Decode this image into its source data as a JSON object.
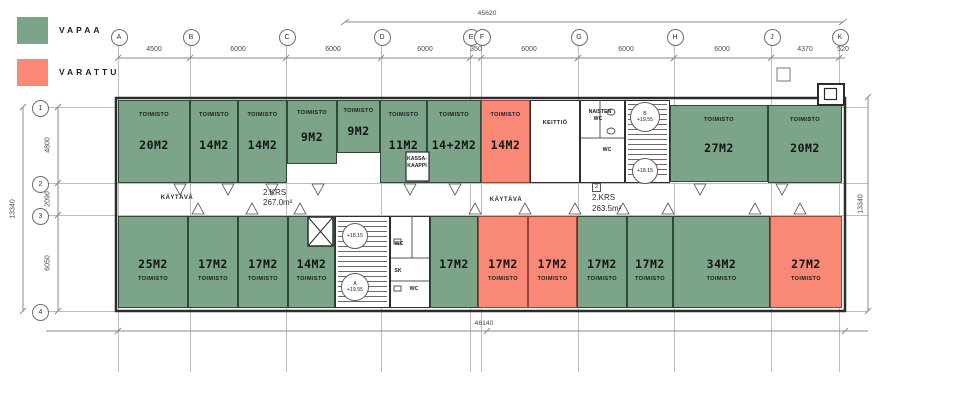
{
  "legend": {
    "items": [
      {
        "id": "vapaa",
        "label": "VAPAA",
        "color": "#7CA489"
      },
      {
        "id": "varattu",
        "label": "VARATTU",
        "color": "#F98877"
      }
    ]
  },
  "colors": {
    "vapaa": "#7CA489",
    "varattu": "#F98877",
    "wall": "#2F2F2F",
    "grid_line": "#BDBDBD",
    "dim_text": "#4C4C4C"
  },
  "dimensions": {
    "top_total": "45620",
    "bottom_total": "46140",
    "left_total": "13340",
    "right_total": "13340",
    "column_spans": [
      {
        "label": "4500",
        "x": 154
      },
      {
        "label": "6000",
        "x": 238
      },
      {
        "label": "6000",
        "x": 333
      },
      {
        "label": "6000",
        "x": 425
      },
      {
        "label": "350",
        "x": 476
      },
      {
        "label": "6000",
        "x": 529
      },
      {
        "label": "6000",
        "x": 626
      },
      {
        "label": "6000",
        "x": 722
      },
      {
        "label": "4370",
        "x": 805
      },
      {
        "label": "520",
        "x": 843
      }
    ],
    "row_spans": [
      {
        "label": "4800",
        "y": 145
      },
      {
        "label": "2090",
        "y": 199
      },
      {
        "label": "6050",
        "y": 263
      }
    ]
  },
  "grid": {
    "columns": [
      {
        "label": "A",
        "x": 118
      },
      {
        "label": "B",
        "x": 190
      },
      {
        "label": "C",
        "x": 286
      },
      {
        "label": "D",
        "x": 381
      },
      {
        "label": "E",
        "x": 470
      },
      {
        "label": "F",
        "x": 481
      },
      {
        "label": "G",
        "x": 578
      },
      {
        "label": "H",
        "x": 674
      },
      {
        "label": "J",
        "x": 771
      },
      {
        "label": "K",
        "x": 839
      }
    ],
    "rows": [
      {
        "label": "1",
        "y": 107
      },
      {
        "label": "2",
        "y": 183
      },
      {
        "label": "3",
        "y": 215
      },
      {
        "label": "4",
        "y": 311
      }
    ]
  },
  "floor_areas": [
    {
      "tag": "",
      "title": "2.KRS",
      "area": "267.0m²",
      "x": 263,
      "y": 188
    },
    {
      "tag": "2",
      "title": "2.KRS",
      "area": "263.5m²",
      "x": 592,
      "y": 183
    }
  ],
  "corridors": [
    {
      "label": "KÄYTÄVÄ",
      "x": 177,
      "y": 198
    },
    {
      "label": "KÄYTÄVÄ",
      "x": 506,
      "y": 200
    }
  ],
  "rooms": [
    {
      "id": "office-20-1",
      "size": "20M2",
      "type": "TOIMISTO",
      "status": "vapaa",
      "row": "top",
      "x": 118,
      "y": 100,
      "w": 72,
      "h": 83
    },
    {
      "id": "office-14-1",
      "size": "14M2",
      "type": "TOIMISTO",
      "status": "vapaa",
      "row": "top",
      "x": 190,
      "y": 100,
      "w": 48,
      "h": 83
    },
    {
      "id": "office-14-2",
      "size": "14M2",
      "type": "TOIMISTO",
      "status": "vapaa",
      "row": "top",
      "x": 238,
      "y": 100,
      "w": 49,
      "h": 83
    },
    {
      "id": "office-9-1",
      "size": "9M2",
      "type": "TOIMISTO",
      "status": "vapaa",
      "row": "top",
      "x": 287,
      "y": 100,
      "w": 50,
      "h": 64
    },
    {
      "id": "office-9-2",
      "size": "9M2",
      "type": "TOIMISTO",
      "status": "vapaa",
      "row": "top",
      "x": 337,
      "y": 100,
      "w": 43,
      "h": 53
    },
    {
      "id": "office-11",
      "size": "11M2",
      "type": "TOIMISTO",
      "status": "vapaa",
      "row": "top",
      "x": 380,
      "y": 100,
      "w": 47,
      "h": 83
    },
    {
      "id": "office-14plus2",
      "size": "14+2M2",
      "type": "TOIMISTO",
      "status": "vapaa",
      "row": "top",
      "x": 427,
      "y": 100,
      "w": 54,
      "h": 83
    },
    {
      "id": "office-14-3",
      "size": "14M2",
      "type": "TOIMISTO",
      "status": "varattu",
      "row": "top",
      "x": 481,
      "y": 100,
      "w": 49,
      "h": 83
    },
    {
      "id": "keittio",
      "size": "",
      "type": "KEITTIÖ",
      "status": "none",
      "row": "top",
      "x": 530,
      "y": 100,
      "w": 50,
      "h": 83
    },
    {
      "id": "naisten-wc",
      "size": "",
      "type": "",
      "status": "none",
      "row": "top",
      "x": 580,
      "y": 100,
      "w": 45,
      "h": 83
    },
    {
      "id": "stairwell-b",
      "size": "",
      "type": "",
      "status": "none",
      "row": "top",
      "x": 625,
      "y": 100,
      "w": 45,
      "h": 83
    },
    {
      "id": "office-27-1",
      "size": "27M2",
      "type": "TOIMISTO",
      "status": "vapaa",
      "row": "top",
      "x": 670,
      "y": 105,
      "w": 98,
      "h": 77
    },
    {
      "id": "office-20-2",
      "size": "20M2",
      "type": "TOIMISTO",
      "status": "vapaa",
      "row": "top",
      "x": 768,
      "y": 105,
      "w": 74,
      "h": 78
    },
    {
      "id": "office-25",
      "size": "25M2",
      "type": "TOIMISTO",
      "status": "vapaa",
      "row": "bottom",
      "x": 118,
      "y": 216,
      "w": 70,
      "h": 92
    },
    {
      "id": "office-17-1",
      "size": "17M2",
      "type": "TOIMISTO",
      "status": "vapaa",
      "row": "bottom",
      "x": 188,
      "y": 216,
      "w": 50,
      "h": 92
    },
    {
      "id": "office-17-2",
      "size": "17M2",
      "type": "TOIMISTO",
      "status": "vapaa",
      "row": "bottom",
      "x": 238,
      "y": 216,
      "w": 50,
      "h": 92
    },
    {
      "id": "office-14-4",
      "size": "14M2",
      "type": "TOIMISTO",
      "status": "vapaa",
      "row": "bottom",
      "x": 288,
      "y": 216,
      "w": 47,
      "h": 92
    },
    {
      "id": "stairwell-a",
      "size": "",
      "type": "",
      "status": "none",
      "row": "bottom",
      "x": 335,
      "y": 216,
      "w": 55,
      "h": 92
    },
    {
      "id": "wc-block",
      "size": "",
      "type": "",
      "status": "none",
      "row": "bottom",
      "x": 390,
      "y": 216,
      "w": 40,
      "h": 92
    },
    {
      "id": "office-17-3",
      "size": "17M2",
      "type": "",
      "status": "vapaa",
      "row": "bottom",
      "x": 430,
      "y": 216,
      "w": 48,
      "h": 92
    },
    {
      "id": "office-17-4",
      "size": "17M2",
      "type": "TOIMISTO",
      "status": "varattu",
      "row": "bottom",
      "x": 478,
      "y": 216,
      "w": 50,
      "h": 92
    },
    {
      "id": "office-17-5",
      "size": "17M2",
      "type": "TOIMISTO",
      "status": "varattu",
      "row": "bottom",
      "x": 528,
      "y": 216,
      "w": 49,
      "h": 92
    },
    {
      "id": "office-17-6",
      "size": "17M2",
      "type": "TOIMISTO",
      "status": "vapaa",
      "row": "bottom",
      "x": 577,
      "y": 216,
      "w": 50,
      "h": 92
    },
    {
      "id": "office-17-7",
      "size": "17M2",
      "type": "TOIMISTO",
      "status": "vapaa",
      "row": "bottom",
      "x": 627,
      "y": 216,
      "w": 46,
      "h": 92
    },
    {
      "id": "office-34",
      "size": "34M2",
      "type": "TOIMISTO",
      "status": "vapaa",
      "row": "bottom",
      "x": 673,
      "y": 216,
      "w": 97,
      "h": 92
    },
    {
      "id": "office-27-2",
      "size": "27M2",
      "type": "TOIMISTO",
      "status": "varattu",
      "row": "bottom",
      "x": 770,
      "y": 216,
      "w": 72,
      "h": 92
    }
  ],
  "level_markers": [
    {
      "x": 645,
      "y": 117,
      "r": 14,
      "lines": [
        "B",
        "+19.55"
      ]
    },
    {
      "x": 645,
      "y": 171,
      "r": 12,
      "lines": [
        "+18.15"
      ]
    },
    {
      "x": 355,
      "y": 236,
      "r": 12,
      "lines": [
        "+18.15"
      ]
    },
    {
      "x": 355,
      "y": 287,
      "r": 13,
      "lines": [
        "A",
        "+19.55"
      ]
    }
  ],
  "small_labels": [
    {
      "text": "NAISTEN",
      "x": 600,
      "y": 112
    },
    {
      "text": "WC",
      "x": 598,
      "y": 119
    },
    {
      "text": "WC",
      "x": 607,
      "y": 150
    },
    {
      "text": "KASSA-",
      "x": 417,
      "y": 159
    },
    {
      "text": "KAAPPI",
      "x": 417,
      "y": 166
    },
    {
      "text": "WC",
      "x": 399,
      "y": 244
    },
    {
      "text": "SK",
      "x": 398,
      "y": 271
    },
    {
      "text": "WC",
      "x": 414,
      "y": 289
    }
  ]
}
